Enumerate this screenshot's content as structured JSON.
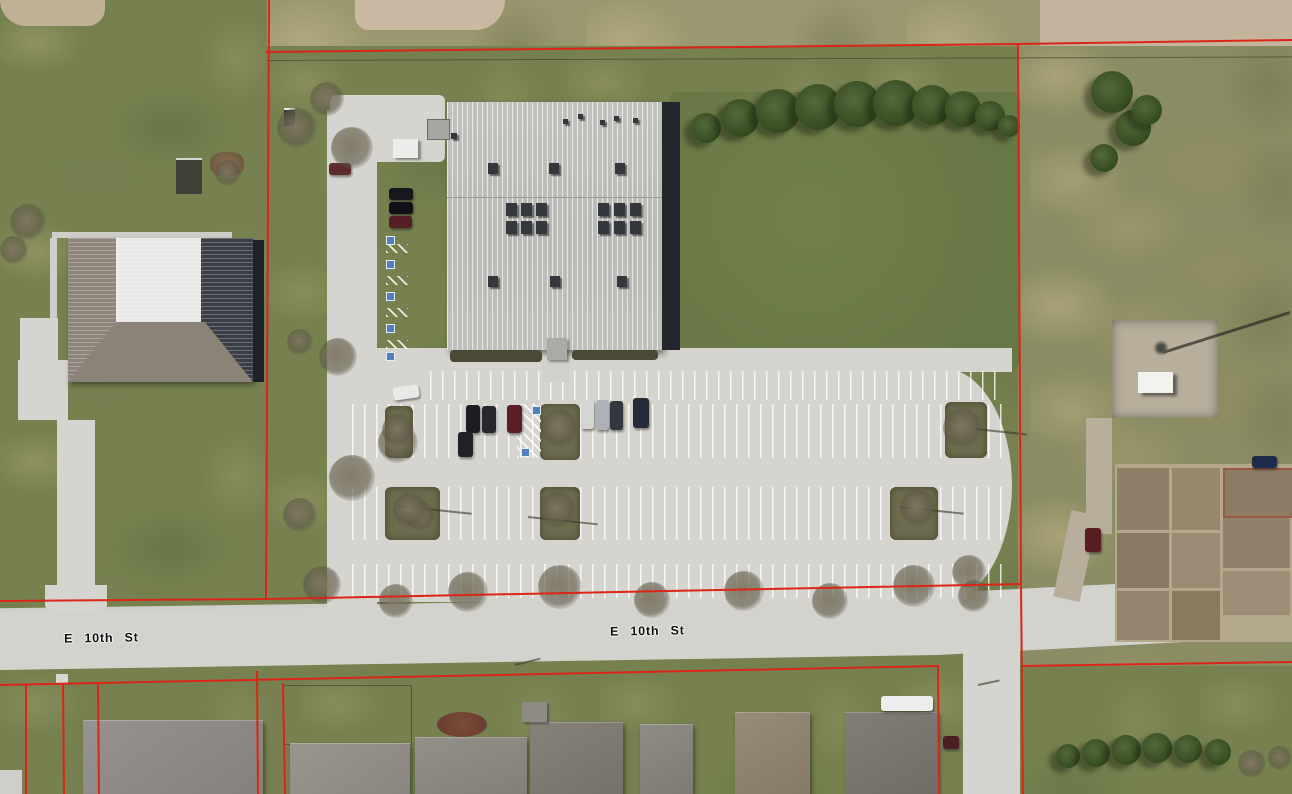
{
  "map": {
    "description": "aerial-parcel-map",
    "street_labels": [
      {
        "text": "E 10th St"
      },
      {
        "text": "E 10th St"
      }
    ],
    "overlay": {
      "parcel_line_color": "#dc2418",
      "parcel_line_width": 2
    },
    "palette": {
      "grass": "#76814f",
      "dry_field": "#c4b49b",
      "concrete": "#d5d4ce",
      "gravel": "#b7ae9c",
      "main_building_roof": "#c7c7c3",
      "building_shadow": "#23262a",
      "left_building_roof_light": "#e9e9e7",
      "left_building_roof_dark": "#3a3e45",
      "evergreen": "#3c512f",
      "label_text": "#0b0b0b"
    },
    "parcel_lines": [
      [
        [
          269,
          0
        ],
        [
          266,
          599
        ]
      ],
      [
        [
          266,
          52
        ],
        [
          1018,
          44
        ],
        [
          1292,
          40
        ]
      ],
      [
        [
          1018,
          44
        ],
        [
          1021,
          584
        ],
        [
          1023,
          794
        ]
      ],
      [
        [
          0,
          601
        ],
        [
          267,
          599
        ],
        [
          1021,
          584
        ]
      ],
      [
        [
          1021,
          666
        ],
        [
          1292,
          662
        ]
      ],
      [
        [
          0,
          685
        ],
        [
          938,
          666
        ],
        [
          939,
          794
        ]
      ],
      [
        [
          26,
          685
        ],
        [
          26,
          794
        ]
      ],
      [
        [
          63,
          684
        ],
        [
          64,
          794
        ]
      ],
      [
        [
          98,
          684
        ],
        [
          99,
          794
        ]
      ],
      [
        [
          257,
          671
        ],
        [
          258,
          794
        ]
      ],
      [
        [
          283,
          683
        ],
        [
          285,
          794
        ]
      ]
    ]
  }
}
